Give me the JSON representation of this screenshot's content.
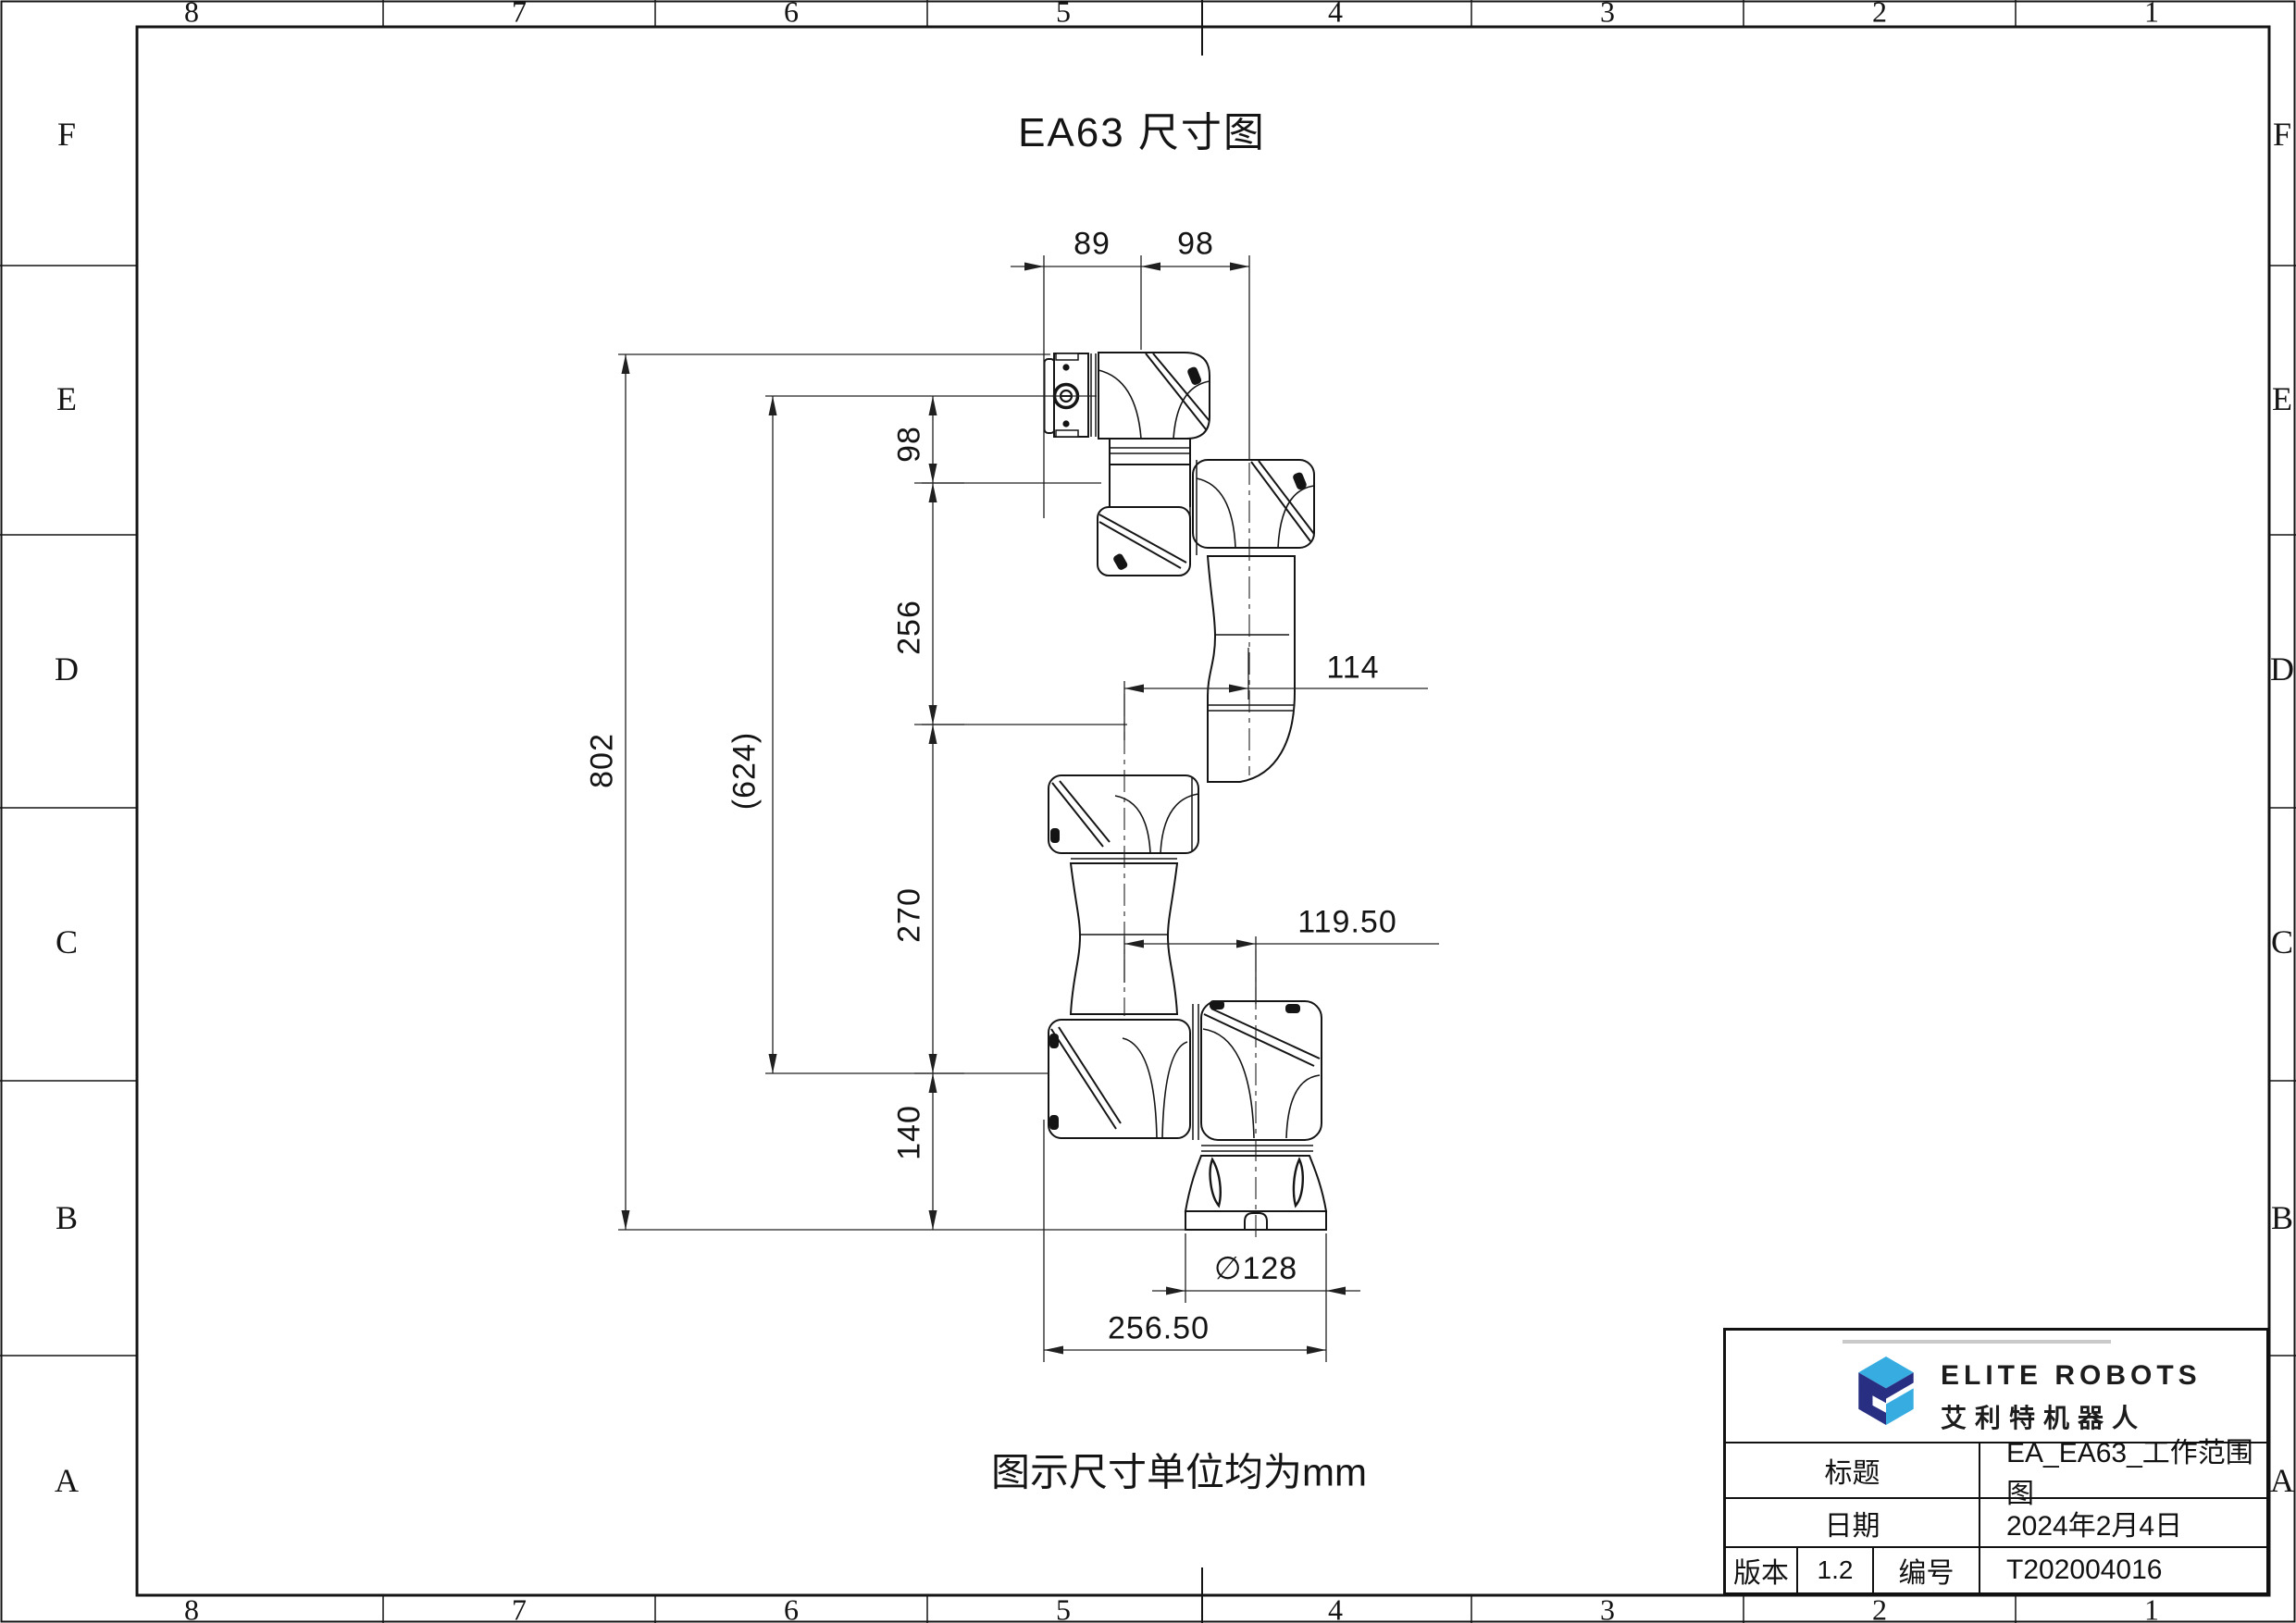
{
  "sheet": {
    "title": "EA63 尺寸图",
    "note": "图示尺寸单位均为mm",
    "border": {
      "columns": [
        "8",
        "7",
        "6",
        "5",
        "4",
        "3",
        "2",
        "1"
      ],
      "rows": [
        "F",
        "E",
        "D",
        "C",
        "B",
        "A"
      ]
    },
    "dimensions": {
      "d89": "89",
      "d98top": "98",
      "d98": "98",
      "d256": "256",
      "d802": "802",
      "d624": "(624)",
      "d270": "270",
      "d140": "140",
      "d114": "114",
      "d119_50": "119.50",
      "d128": "∅128",
      "d256_50": "256.50"
    },
    "title_block": {
      "brand_en": "ELITE ROBOTS",
      "brand_cn": "艾利特机器人",
      "title_label": "标题",
      "title_value": "EA_EA63_工作范围图",
      "date_label": "日期",
      "date_value": "2024年2月4日",
      "version_label": "版本",
      "version_value": "1.2",
      "code_label": "编号",
      "code_value": "T202004016"
    },
    "colors": {
      "logo_dark": "#282f82",
      "logo_light": "#36ace1",
      "line": "#141414"
    }
  }
}
